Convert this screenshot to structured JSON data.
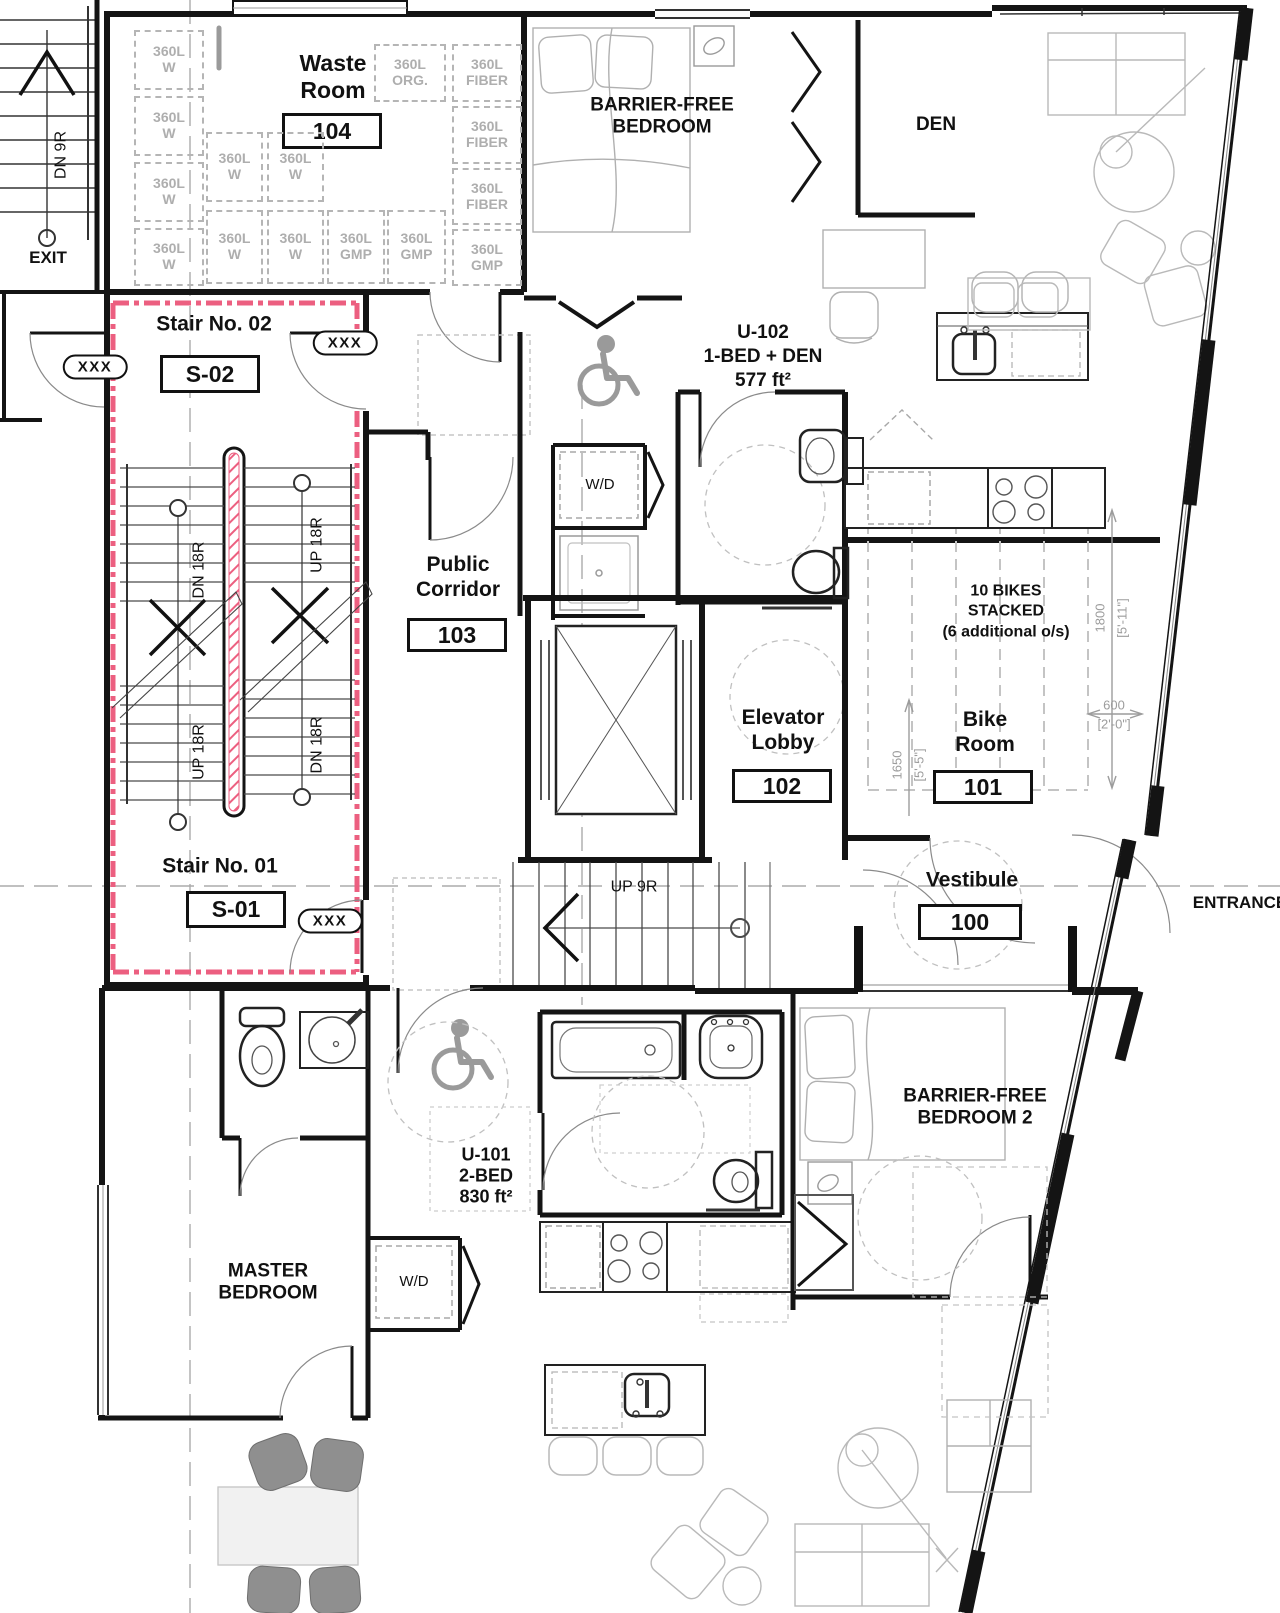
{
  "plan": {
    "rooms": {
      "waste_room": {
        "name": "Waste\nRoom",
        "number": "104"
      },
      "stair_02": {
        "name": "Stair No. 02",
        "number": "S-02"
      },
      "stair_01": {
        "name": "Stair No. 01",
        "number": "S-01"
      },
      "public_corridor": {
        "name": "Public\nCorridor",
        "number": "103"
      },
      "elevator_lobby": {
        "name": "Elevator\nLobby",
        "number": "102"
      },
      "bike_room": {
        "name": "Bike\nRoom",
        "number": "101"
      },
      "vestibule": {
        "name": "Vestibule",
        "number": "100"
      }
    },
    "units": {
      "u102": {
        "id": "U-102",
        "layout": "1-BED + DEN",
        "area": "577 ft²"
      },
      "u101": {
        "id": "U-101",
        "layout": "2-BED",
        "area": "830 ft²"
      }
    },
    "areas": {
      "barrier_free_bedroom": "BARRIER-FREE\nBEDROOM",
      "den": "DEN",
      "master_bedroom": "MASTER\nBEDROOM",
      "barrier_free_bedroom_2": "BARRIER-FREE\nBEDROOM 2"
    },
    "circulation": {
      "exit": "EXIT",
      "entrance": "ENTRANCE",
      "dn_9r": "DN 9R",
      "up_9r": "UP 9R",
      "up_18r": "UP 18R",
      "dn_18r": "DN 18R",
      "door_tag": "XXX"
    },
    "equipment": {
      "washer_dryer": "W/D"
    },
    "bike_storage": {
      "line1": "10 BIKES",
      "line2": "STACKED",
      "line3": "(6 additional o/s)"
    },
    "bins": {
      "water": "360L\nW",
      "organics": "360L\nORG.",
      "fiber": "360L\nFIBER",
      "gmp": "360L\nGMP"
    },
    "dimensions": {
      "bike_depth_mm": "1800",
      "bike_depth_imp": "[5'-11\"]",
      "bike_width_mm": "600",
      "bike_width_imp": "[2'-0\"]",
      "bike_clear_mm": "1650",
      "bike_clear_imp": "[5'-5\"]"
    },
    "colors": {
      "fire_rating_pink": "#ec5f80"
    }
  }
}
